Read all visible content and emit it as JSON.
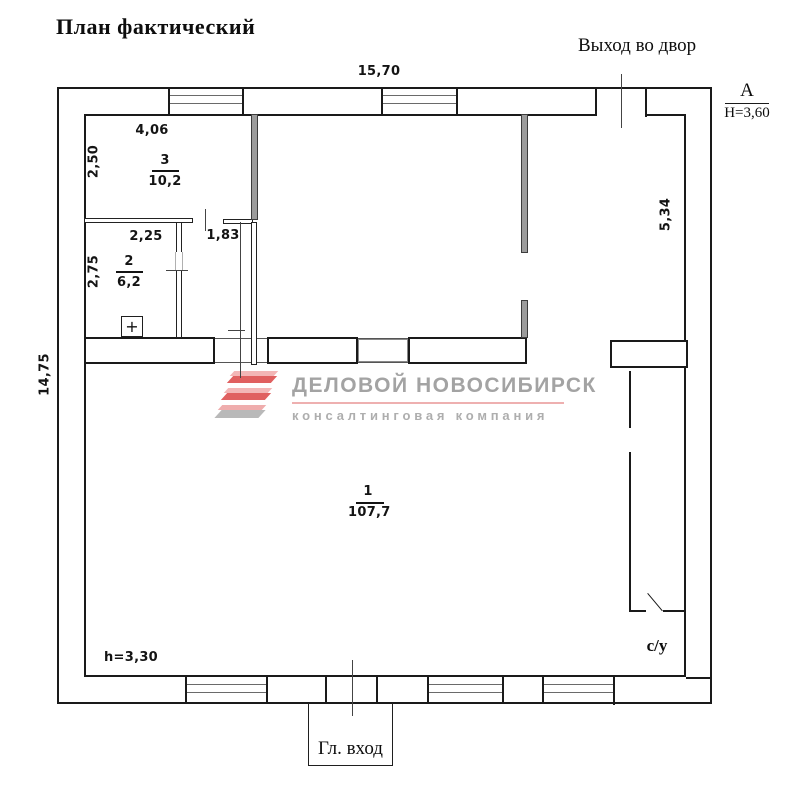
{
  "title": "План фактический",
  "labels": {
    "exit_yard": "Выход во двор",
    "main_entrance": "Гл. вход",
    "wc": "с/у",
    "ceiling_height_room1": "h=3,30",
    "section_mark": "А",
    "section_height": "Н=3,60",
    "plus_mark": "+"
  },
  "dimensions": {
    "top_width": "15,70",
    "left_height": "14,75",
    "right_side": "5,34",
    "room3_width": "4,06",
    "room3_depth": "2,50",
    "room2_width": "2,25",
    "hall_width": "1,83",
    "room2_depth": "2,75"
  },
  "rooms": {
    "room1": {
      "number": "1",
      "area": "107,7"
    },
    "room2": {
      "number": "2",
      "area": "6,2"
    },
    "room3": {
      "number": "3",
      "area": "10,2"
    }
  },
  "watermark": {
    "company": "ДЕЛОВОЙ НОВОСИБИРСК",
    "tagline": "консалтинговая компания",
    "brand_red": "#e06060",
    "brand_pink": "#f3b6b6",
    "brand_gray": "#b9b9b9",
    "text_gray": "#a3a3a3",
    "bar_pink": "#eeb0b0"
  }
}
